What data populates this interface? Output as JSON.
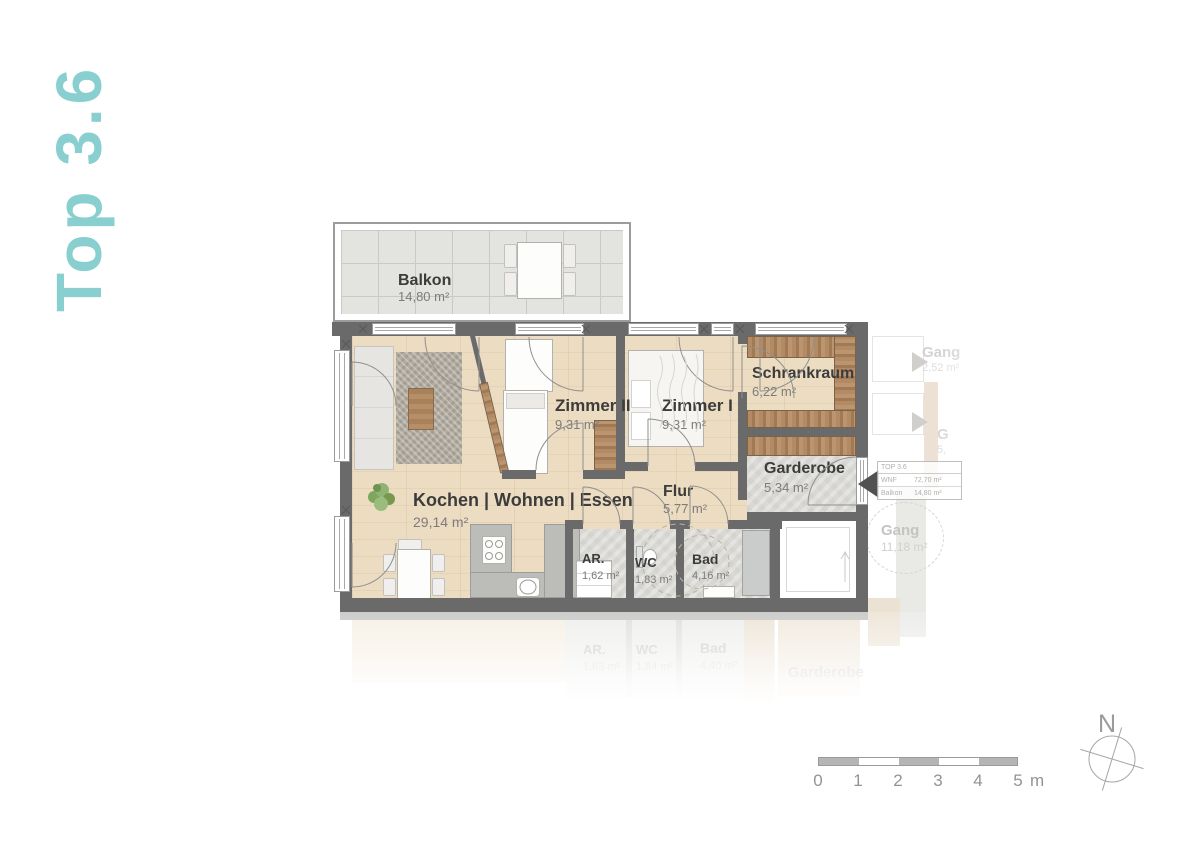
{
  "title": "Top 3.6",
  "rooms": {
    "balkon": {
      "name": "Balkon",
      "area": "14,80 m²"
    },
    "wohnen": {
      "name": "Kochen | Wohnen | Essen",
      "area": "29,14 m²"
    },
    "zimmer2": {
      "name": "Zimmer II",
      "area": "9,31 m²"
    },
    "zimmer1": {
      "name": "Zimmer I",
      "area": "9,31 m²"
    },
    "schrankraum": {
      "name": "Schrankraum",
      "area": "6,22 m²"
    },
    "garderobe": {
      "name": "Garderobe",
      "area": "5,34 m²"
    },
    "flur": {
      "name": "Flur",
      "area": "5,77 m²"
    },
    "ar": {
      "name": "AR.",
      "area": "1,62 m²"
    },
    "wc": {
      "name": "WC",
      "area": "1,83 m²"
    },
    "bad": {
      "name": "Bad",
      "area": "4,16 m²"
    }
  },
  "unit_info": {
    "top": "TOP 3.6",
    "wnf_label": "WNF",
    "wnf_value": "72,70 m²",
    "balkon_label": "Balkon",
    "balkon_value": "14,80 m²"
  },
  "neighbors": {
    "gang_upper": {
      "name": "Gang",
      "area": "2,52 m²"
    },
    "fragment": {
      "name": "G",
      "area": "5,"
    },
    "gang_lower": {
      "name": "Gang",
      "area": "11,18 m²"
    }
  },
  "reflection": {
    "ar": {
      "name": "AR.",
      "area": "1,63 m²"
    },
    "wc": {
      "name": "WC",
      "area": "1,84 m²"
    },
    "bad": {
      "name": "Bad",
      "area": "4,40 m²"
    },
    "garderobe": {
      "name": "Garderobe",
      "area": ""
    }
  },
  "scale_bar": {
    "labels": [
      "0",
      "1",
      "2",
      "3",
      "4",
      "5"
    ],
    "unit": "m"
  },
  "compass": {
    "north": "N"
  },
  "colors": {
    "accent": "#8bd0d1",
    "wall": "#6a6a6a",
    "wood_floor": "#ecdcc1",
    "wood_furniture": "#b08a63",
    "stone_floor": "#d9d8d4"
  }
}
